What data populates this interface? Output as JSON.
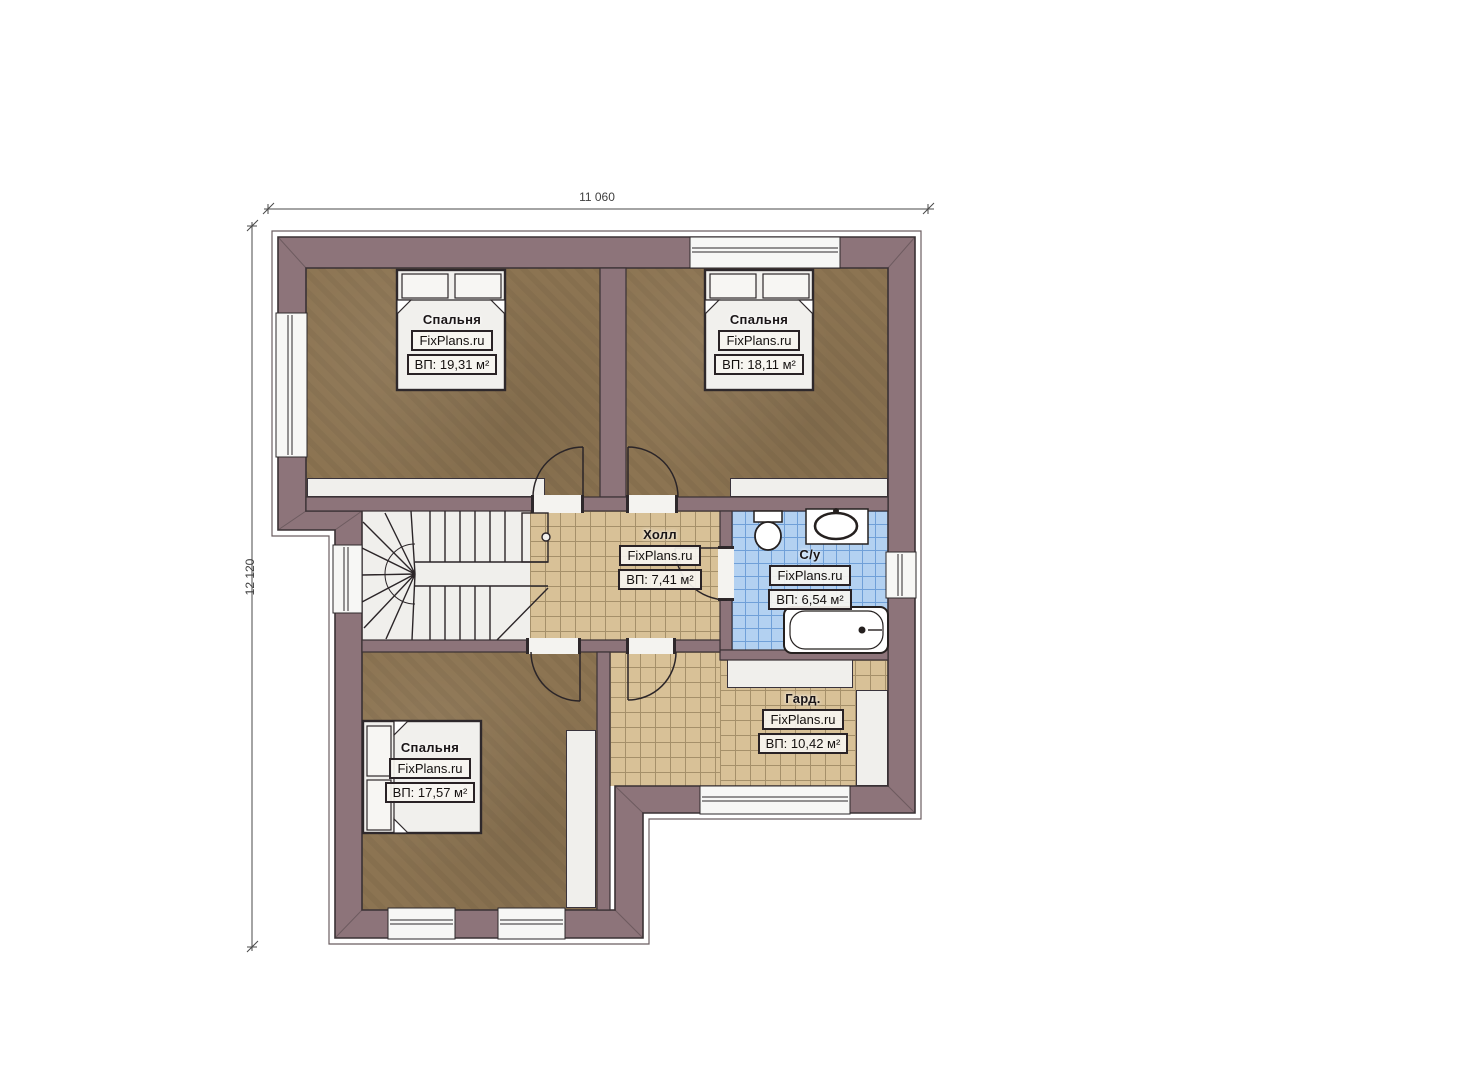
{
  "plan": {
    "type": "floor-plan",
    "dimensions": {
      "width_label": "11 060",
      "height_label": "12 120"
    },
    "brand": "FixPlans.ru",
    "rooms": {
      "bedroom1": {
        "name": "Спальня",
        "brand": "FixPlans.ru",
        "area": "ВП: 19,31 м²"
      },
      "bedroom2": {
        "name": "Спальня",
        "brand": "FixPlans.ru",
        "area": "ВП: 18,11 м²"
      },
      "hall": {
        "name": "Холл",
        "brand": "FixPlans.ru",
        "area": "ВП: 7,41 м²"
      },
      "bathroom": {
        "name": "С/у",
        "brand": "FixPlans.ru",
        "area": "ВП: 6,54 м²"
      },
      "wardrobe": {
        "name": "Гард.",
        "brand": "FixPlans.ru",
        "area": "ВП: 10,42 м²"
      },
      "bedroom3": {
        "name": "Спальня",
        "brand": "FixPlans.ru",
        "area": "ВП: 17,57 м²"
      }
    },
    "colors": {
      "wall": "#8d747a",
      "wood_floor": "#8c7452",
      "tile_tan": "#d8c197",
      "tile_blue": "#b3d1f1",
      "stair_floor": "#f0efec"
    }
  }
}
